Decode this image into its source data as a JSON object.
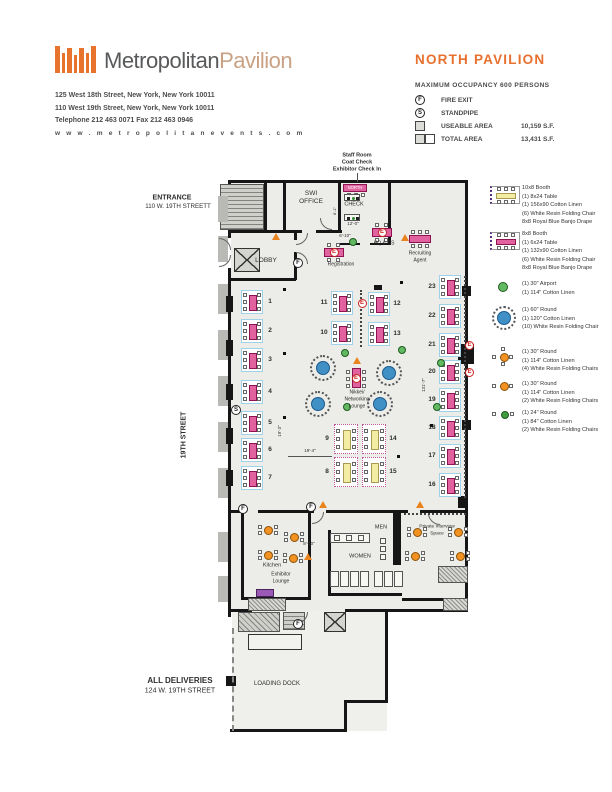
{
  "header": {
    "brand_primary": "Metropolitan",
    "brand_secondary": "Pavilion",
    "address_lines": [
      "125 West 18th Street, New York, New York 10011",
      "110 West 19th Street, New York, New York 10011",
      "Telephone  212 463 0071    Fax  212 463 0946",
      "w w w . m e t r o p o l i t a n e v e n t s . c o m"
    ]
  },
  "title_block": {
    "title": "NORTH PAVILION",
    "occupancy": "MAXIMUM OCCUPANCY 600 PERSONS",
    "fire_exit_symbol": "F",
    "fire_exit_label": "FIRE EXIT",
    "standpipe_symbol": "S",
    "standpipe_label": "STANDPIPE",
    "useable_label": "USEABLE AREA",
    "useable_value": "10,159  S.F.",
    "total_label": "TOTAL AREA",
    "total_value": "13,431  S.F."
  },
  "legend": [
    {
      "icon": "booth-10x8-icon",
      "y": 188,
      "lines": [
        "10x8 Booth",
        "(1) 8x24 Table",
        "(1) 156x90 Cotton Linen",
        "(6) White Resin Folding Chair",
        "8x8 Royal Blue Banjo Drape"
      ]
    },
    {
      "icon": "booth-8x8-icon",
      "y": 234,
      "lines": [
        "8x8 Booth",
        "(1) 6x24 Table",
        "(1) 132x90 Cotton Linen",
        "(6) White Resin Folding Chair",
        "8x8 Royal Blue Banjo Drape"
      ]
    },
    {
      "icon": "airport-30-icon",
      "y": 284,
      "lines": [
        "(1) 30\" Airport",
        "(1) 114\" Cotton Linen"
      ]
    },
    {
      "icon": "round-60-icon",
      "y": 310,
      "lines": [
        "(1) 60\" Round",
        "(1) 120\" Cotton Linen",
        "(10) White Resin Folding Chair"
      ]
    },
    {
      "icon": "round-30-4chair-icon",
      "y": 352,
      "lines": [
        "(1) 30\" Round",
        "(1) 114\" Cotton Linen",
        "(4) White Resin Folding Chairs"
      ]
    },
    {
      "icon": "round-30-2chair-icon",
      "y": 384,
      "lines": [
        "(1) 30\" Round",
        "(1) 114\" Cotton Linen",
        "(2) White Resin Folding Chairs"
      ]
    },
    {
      "icon": "round-24-2chair-icon",
      "y": 413,
      "lines": [
        "(1) 24\" Round",
        "(1) 84\" Cotton Linen",
        "(2) White Resin Folding Chairs"
      ]
    }
  ],
  "plan": {
    "labels": [
      {
        "id": "staff-room-note-1",
        "t": "Staff Room",
        "x": 357,
        "y": 156,
        "fs": 5.5,
        "b": true
      },
      {
        "id": "staff-room-note-2",
        "t": "Coat Check",
        "x": 357,
        "y": 163,
        "fs": 5.5,
        "b": true
      },
      {
        "id": "staff-room-note-3",
        "t": "Exhibitor Check In",
        "x": 357,
        "y": 170,
        "fs": 5.5,
        "b": true
      },
      {
        "id": "entrance-label-1",
        "t": "ENTRANCE",
        "x": 172,
        "y": 198,
        "fs": 7,
        "b": true
      },
      {
        "id": "entrance-label-2",
        "t": "110 W. 19TH STREETT",
        "x": 178,
        "y": 207,
        "fs": 6.2
      },
      {
        "id": "street-label",
        "t": "19TH STREET",
        "x": 184,
        "y": 435,
        "fs": 7,
        "b": true,
        "r": true
      },
      {
        "id": "deliveries-label-1",
        "t": "ALL DELIVERIES",
        "x": 180,
        "y": 681,
        "fs": 8,
        "b": true
      },
      {
        "id": "deliveries-label-2",
        "t": "124 W. 19TH STREET",
        "x": 180,
        "y": 691,
        "fs": 7
      },
      {
        "id": "loading-dock-label",
        "t": "LOADING DOCK",
        "x": 277,
        "y": 684,
        "fs": 6
      },
      {
        "id": "swi-office-label-1",
        "t": "SWI",
        "x": 311,
        "y": 194,
        "fs": 6.5
      },
      {
        "id": "swi-office-label-2",
        "t": "OFFICE",
        "x": 311,
        "y": 202,
        "fs": 6.5
      },
      {
        "id": "north-desk-label",
        "t": "NORTH",
        "x": 355,
        "y": 188,
        "fs": 4.2,
        "wh": true
      },
      {
        "id": "check-label",
        "t": "CHECK",
        "x": 354,
        "y": 205,
        "fs": 5.5
      },
      {
        "id": "lobby-label",
        "t": "LOBBY",
        "x": 266,
        "y": 261,
        "fs": 6.5
      },
      {
        "id": "registration-label",
        "t": "Registration",
        "x": 341,
        "y": 265,
        "fs": 5
      },
      {
        "id": "hq-os-label",
        "t": "HQ & OS",
        "x": 384,
        "y": 244,
        "fs": 5
      },
      {
        "id": "recruiting-label-1",
        "t": "Recruiting",
        "x": 420,
        "y": 254,
        "fs": 5
      },
      {
        "id": "recruiting-label-2",
        "t": "Agent",
        "x": 420,
        "y": 261,
        "fs": 5
      },
      {
        "id": "nikkei-label-1",
        "t": "Nikkei/",
        "x": 357,
        "y": 393,
        "fs": 5
      },
      {
        "id": "nikkei-label-2",
        "t": "Networking",
        "x": 357,
        "y": 400,
        "fs": 5
      },
      {
        "id": "nikkei-label-3",
        "t": "Lounge",
        "x": 357,
        "y": 407,
        "fs": 5
      },
      {
        "id": "men-label",
        "t": "MEN",
        "x": 381,
        "y": 528,
        "fs": 5.5
      },
      {
        "id": "women-label",
        "t": "WOMEN",
        "x": 360,
        "y": 557,
        "fs": 5.5
      },
      {
        "id": "kitchen-label",
        "t": "Kitchen",
        "x": 272,
        "y": 566,
        "fs": 5.5
      },
      {
        "id": "exhibitor-lounge-label-1",
        "t": "Exhibitor",
        "x": 281,
        "y": 575,
        "fs": 5
      },
      {
        "id": "exhibitor-lounge-label-2",
        "t": "Lounge",
        "x": 281,
        "y": 582,
        "fs": 5
      },
      {
        "id": "private-interview-label-1",
        "t": "Private Interview",
        "x": 437,
        "y": 528,
        "fs": 4.8
      },
      {
        "id": "private-interview-label-2",
        "t": "Space",
        "x": 437,
        "y": 535,
        "fs": 4.8
      },
      {
        "id": "dim-12-0",
        "t": "12'-0\"",
        "x": 353,
        "y": 224,
        "fs": 4.5
      },
      {
        "id": "dim-8-1",
        "t": "8'-1\"",
        "x": 335,
        "y": 211,
        "fs": 4,
        "r": true
      },
      {
        "id": "dim-6-10",
        "t": "6'-10\"",
        "x": 345,
        "y": 236,
        "fs": 4.5
      },
      {
        "id": "dim-19-3",
        "t": "19'-3\"",
        "x": 280,
        "y": 431,
        "fs": 4.5,
        "r": true
      },
      {
        "id": "dim-19-4",
        "t": "19'-4\"",
        "x": 310,
        "y": 451,
        "fs": 4.5
      },
      {
        "id": "dim-8-10",
        "t": "8'-10\"",
        "x": 309,
        "y": 544,
        "fs": 4.5
      },
      {
        "id": "dim-131-7",
        "t": "131'-7\"",
        "x": 424,
        "y": 385,
        "fs": 4.5,
        "r": true
      }
    ],
    "booths": [
      {
        "n": "1",
        "x": 252,
        "y": 302,
        "num": "right"
      },
      {
        "n": "2",
        "x": 252,
        "y": 331,
        "num": "right"
      },
      {
        "n": "3",
        "x": 252,
        "y": 360,
        "num": "right"
      },
      {
        "n": "4",
        "x": 252,
        "y": 392,
        "num": "right"
      },
      {
        "n": "5",
        "x": 252,
        "y": 423,
        "num": "right"
      },
      {
        "n": "6",
        "x": 252,
        "y": 450,
        "num": "right"
      },
      {
        "n": "7",
        "x": 252,
        "y": 478,
        "num": "right"
      },
      {
        "n": "11",
        "x": 342,
        "y": 303,
        "num": "left"
      },
      {
        "n": "12",
        "x": 379,
        "y": 304,
        "num": "right"
      },
      {
        "n": "10",
        "x": 342,
        "y": 333,
        "num": "left"
      },
      {
        "n": "13",
        "x": 379,
        "y": 334,
        "num": "right"
      },
      {
        "n": "23",
        "x": 450,
        "y": 287,
        "num": "left"
      },
      {
        "n": "22",
        "x": 450,
        "y": 316,
        "num": "left"
      },
      {
        "n": "21",
        "x": 450,
        "y": 345,
        "num": "left",
        "e": true
      },
      {
        "n": "20",
        "x": 450,
        "y": 372,
        "num": "left",
        "e": true
      },
      {
        "n": "19",
        "x": 450,
        "y": 400,
        "num": "left"
      },
      {
        "n": "18",
        "x": 450,
        "y": 428,
        "num": "left"
      },
      {
        "n": "17",
        "x": 450,
        "y": 456,
        "num": "left"
      },
      {
        "n": "16",
        "x": 450,
        "y": 485,
        "num": "left"
      }
    ],
    "booths_yellow": [
      {
        "n": "9",
        "x": 346,
        "y": 439,
        "num": "left"
      },
      {
        "n": "14",
        "x": 374,
        "y": 439,
        "num": "right"
      },
      {
        "n": "8",
        "x": 346,
        "y": 472,
        "num": "left"
      },
      {
        "n": "15",
        "x": 374,
        "y": 472,
        "num": "right"
      }
    ],
    "rounds_60": [
      [
        323,
        368
      ],
      [
        389,
        373
      ],
      [
        318,
        404
      ],
      [
        380,
        404
      ]
    ],
    "airports_30": [
      [
        345,
        353
      ],
      [
        402,
        350
      ],
      [
        441,
        363
      ],
      [
        437,
        407
      ],
      [
        347,
        407
      ],
      [
        353,
        242
      ]
    ],
    "rounds_30": [
      [
        268,
        530
      ],
      [
        294,
        537
      ],
      [
        268,
        555
      ],
      [
        293,
        558
      ],
      [
        417,
        532
      ],
      [
        458,
        532
      ],
      [
        415,
        556
      ],
      [
        460,
        556
      ]
    ],
    "e_tables": [
      [
        334,
        252
      ],
      [
        382,
        232
      ]
    ],
    "e_circles": [
      [
        362,
        303
      ]
    ],
    "nikkei_table": [
      356,
      378
    ],
    "recruiting_table": [
      420,
      239
    ],
    "north_table": [
      355,
      188
    ],
    "check_tables": [
      [
        352,
        197
      ],
      [
        352,
        217
      ]
    ],
    "fire_exits": [
      [
        298,
        263
      ],
      [
        243,
        509
      ],
      [
        311,
        507
      ],
      [
        298,
        624
      ]
    ],
    "standpipes": [
      [
        236,
        410
      ]
    ],
    "triangles": [
      [
        276,
        240
      ],
      [
        405,
        241
      ],
      [
        357,
        364
      ],
      [
        323,
        508
      ],
      [
        420,
        508
      ],
      [
        308,
        560
      ]
    ],
    "columns": [
      [
        283,
        288
      ],
      [
        400,
        281
      ],
      [
        283,
        352
      ],
      [
        283,
        416
      ],
      [
        397,
        455
      ],
      [
        430,
        424
      ]
    ]
  },
  "colors": {
    "accent_orange": "#e8732c",
    "brand_tan": "#c9a184",
    "booth_pink": "#e0629f",
    "booth_yellow": "#f2eda2",
    "round_blue": "#4090c6",
    "airport_green": "#62b962",
    "table_orange": "#f29222",
    "e_marker_red": "#cc2222",
    "wall_black": "#161616"
  }
}
